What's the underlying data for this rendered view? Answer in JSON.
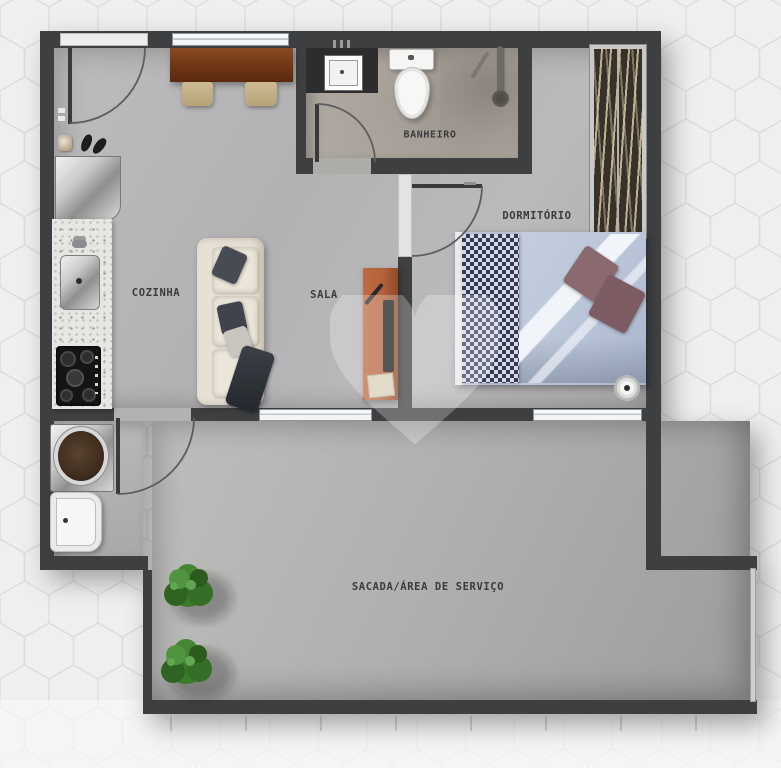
{
  "plan": {
    "kind": "apartment floor plan (top view)",
    "watermark_icon": "heart"
  },
  "rooms": [
    {
      "id": "cozinha",
      "label": "COZINHA"
    },
    {
      "id": "sala",
      "label": "SALA"
    },
    {
      "id": "banheiro",
      "label": "BANHEIRO"
    },
    {
      "id": "dormitorio",
      "label": "DORMITÓRIO"
    },
    {
      "id": "sacada",
      "label": "SACADA/ÁREA DE SERVIÇO"
    }
  ],
  "colors": {
    "wall": "#3e3f41",
    "floor_main": "#b5b5b7",
    "floor_bathroom": "#a8a29a",
    "floor_balcony": "#abaaa8",
    "background_tile": "#eff0ee",
    "tile_line": "#dcdddb",
    "bed_duvet": "#c3cddd",
    "bed_runner_dark": "#343a55",
    "bed_pillow": "#8a6a6e",
    "sofa": "#e7e1d5",
    "sofa_pillow": "#474c54",
    "tv_rack": "#b4633c",
    "dining_table": "#7d4220",
    "chair": "#c9b68c",
    "plant": "#3c7a2c",
    "label_text": "#3b3b3d"
  }
}
